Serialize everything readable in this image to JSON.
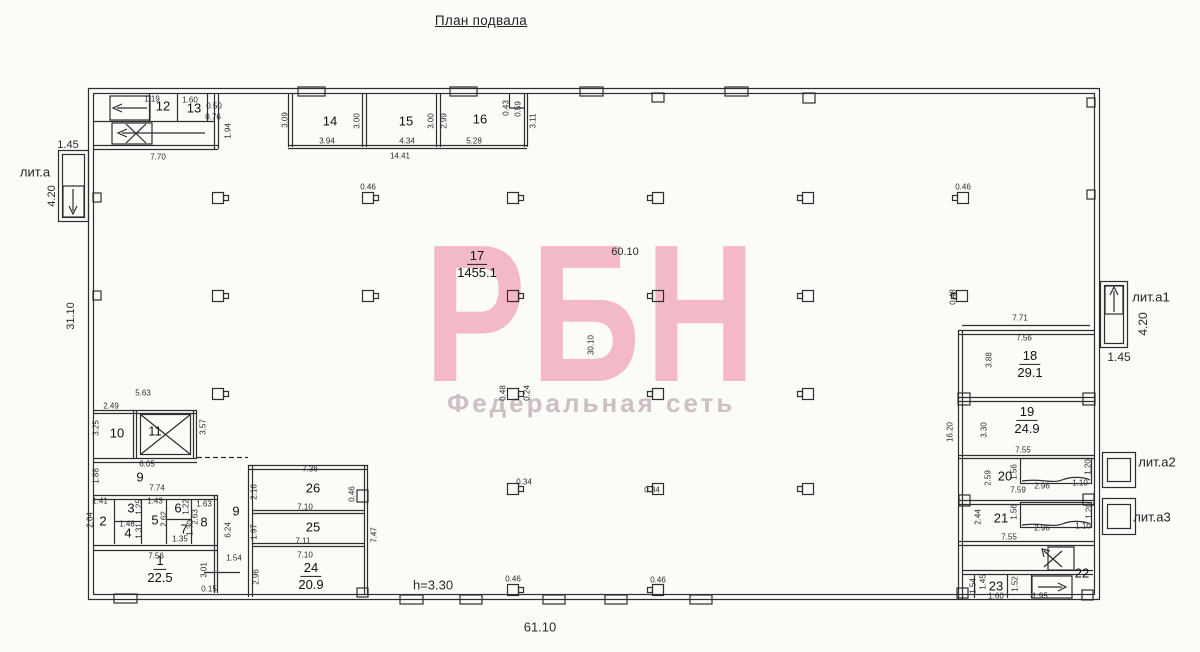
{
  "title": "План подвала",
  "watermark": {
    "brand": "РБН",
    "subtitle": "Федеральная сеть",
    "brand_color": "#f4b9c6",
    "subtitle_color": "#cdbfc3"
  },
  "plan": {
    "literas": [
      {
        "t": "лит.а",
        "x": 35,
        "y": 172
      },
      {
        "t": "лит.а1",
        "x": 1151,
        "y": 297
      },
      {
        "t": "лит.а2",
        "x": 1157,
        "y": 462
      },
      {
        "t": "лит.а3",
        "x": 1152,
        "y": 517
      }
    ],
    "rooms_with_area": [
      {
        "num": "17",
        "area": "1455.1",
        "x": 477,
        "y": 265
      },
      {
        "num": "18",
        "area": "29.1",
        "x": 1030,
        "y": 365
      },
      {
        "num": "19",
        "area": "24.9",
        "x": 1027,
        "y": 421
      },
      {
        "num": "24",
        "area": "20.9",
        "x": 311,
        "y": 577
      },
      {
        "num": "1",
        "area": "22.5",
        "x": 160,
        "y": 570
      }
    ],
    "room_numbers": [
      {
        "t": "12",
        "x": 163,
        "y": 106
      },
      {
        "t": "13",
        "x": 194,
        "y": 108
      },
      {
        "t": "14",
        "x": 330,
        "y": 121
      },
      {
        "t": "15",
        "x": 406,
        "y": 121
      },
      {
        "t": "16",
        "x": 480,
        "y": 119
      },
      {
        "t": "20",
        "x": 1005,
        "y": 476
      },
      {
        "t": "21",
        "x": 1001,
        "y": 518
      },
      {
        "t": "22",
        "x": 1082,
        "y": 573
      },
      {
        "t": "23",
        "x": 996,
        "y": 586
      },
      {
        "t": "25",
        "x": 313,
        "y": 527
      },
      {
        "t": "26",
        "x": 313,
        "y": 488
      },
      {
        "t": "2",
        "x": 103,
        "y": 521
      },
      {
        "t": "3",
        "x": 131,
        "y": 508
      },
      {
        "t": "4",
        "x": 128,
        "y": 533
      },
      {
        "t": "5",
        "x": 155,
        "y": 520
      },
      {
        "t": "6",
        "x": 178,
        "y": 508
      },
      {
        "t": "7",
        "x": 184,
        "y": 529
      },
      {
        "t": "8",
        "x": 204,
        "y": 522
      },
      {
        "t": "9",
        "x": 140,
        "y": 477
      },
      {
        "t": "9",
        "x": 236,
        "y": 511
      },
      {
        "t": "10",
        "x": 117,
        "y": 433
      },
      {
        "t": "11",
        "x": 155,
        "y": 431
      }
    ],
    "dims": [
      {
        "t": "1.45",
        "x": 68,
        "y": 145,
        "s": 11
      },
      {
        "t": "4.20",
        "x": 52,
        "y": 196,
        "s": 11,
        "r": 1
      },
      {
        "t": "31.10",
        "x": 71,
        "y": 316,
        "s": 11,
        "r": 1
      },
      {
        "t": "1.19",
        "x": 152,
        "y": 99
      },
      {
        "t": "1.60",
        "x": 190,
        "y": 100
      },
      {
        "t": "0.50",
        "x": 214,
        "y": 106
      },
      {
        "t": "0.76",
        "x": 213,
        "y": 117
      },
      {
        "t": "1.94",
        "x": 228,
        "y": 131,
        "r": 1
      },
      {
        "t": "7.70",
        "x": 158,
        "y": 157
      },
      {
        "t": "3.09",
        "x": 285,
        "y": 120,
        "r": 1
      },
      {
        "t": "3.94",
        "x": 327,
        "y": 141
      },
      {
        "t": "3.00",
        "x": 357,
        "y": 121,
        "r": 1
      },
      {
        "t": "4.34",
        "x": 407,
        "y": 141
      },
      {
        "t": "3.00",
        "x": 431,
        "y": 121,
        "r": 1
      },
      {
        "t": "14.41",
        "x": 400,
        "y": 156
      },
      {
        "t": "2.99",
        "x": 444,
        "y": 121,
        "r": 1
      },
      {
        "t": "5.28",
        "x": 474,
        "y": 141
      },
      {
        "t": "0.43",
        "x": 506,
        "y": 108,
        "r": 1
      },
      {
        "t": "0.59",
        "x": 518,
        "y": 109,
        "r": 1
      },
      {
        "t": "3.11",
        "x": 533,
        "y": 121,
        "r": 1
      },
      {
        "t": "0.46",
        "x": 368,
        "y": 187
      },
      {
        "t": "0.46",
        "x": 963,
        "y": 187
      },
      {
        "t": "0.48",
        "x": 953,
        "y": 297,
        "r": 1
      },
      {
        "t": "60.10",
        "x": 625,
        "y": 252,
        "s": 11
      },
      {
        "t": "30.10",
        "x": 591,
        "y": 345,
        "r": 1
      },
      {
        "t": "0.48",
        "x": 503,
        "y": 393,
        "r": 1
      },
      {
        "t": "0.24",
        "x": 527,
        "y": 393,
        "r": 1
      },
      {
        "t": "0.34",
        "x": 524,
        "y": 482
      },
      {
        "t": "0.34",
        "x": 652,
        "y": 490
      },
      {
        "t": "0.46",
        "x": 513,
        "y": 579
      },
      {
        "t": "0.46",
        "x": 658,
        "y": 580
      },
      {
        "t": "7.71",
        "x": 1020,
        "y": 318
      },
      {
        "t": "7.56",
        "x": 1024,
        "y": 338
      },
      {
        "t": "3.88",
        "x": 989,
        "y": 360,
        "r": 1
      },
      {
        "t": "16.20",
        "x": 950,
        "y": 432,
        "r": 1
      },
      {
        "t": "3.30",
        "x": 984,
        "y": 430,
        "r": 1
      },
      {
        "t": "7.55",
        "x": 1023,
        "y": 450
      },
      {
        "t": "2.59",
        "x": 988,
        "y": 478,
        "r": 1
      },
      {
        "t": "1.56",
        "x": 1014,
        "y": 472,
        "r": 1
      },
      {
        "t": "2.96",
        "x": 1042,
        "y": 486
      },
      {
        "t": "1.10",
        "x": 1080,
        "y": 483
      },
      {
        "t": "1.20",
        "x": 1088,
        "y": 467,
        "r": 1
      },
      {
        "t": "7.59",
        "x": 1018,
        "y": 490
      },
      {
        "t": "2.44",
        "x": 978,
        "y": 517,
        "r": 1
      },
      {
        "t": "1.56",
        "x": 1014,
        "y": 512,
        "r": 1
      },
      {
        "t": "2.96",
        "x": 1042,
        "y": 528
      },
      {
        "t": "1.10",
        "x": 1083,
        "y": 526
      },
      {
        "t": "1.20",
        "x": 1089,
        "y": 511,
        "r": 1
      },
      {
        "t": "7.55",
        "x": 1009,
        "y": 537
      },
      {
        "t": "1.54",
        "x": 973,
        "y": 586,
        "r": 1
      },
      {
        "t": "1.45",
        "x": 983,
        "y": 582,
        "r": 1
      },
      {
        "t": "1.52",
        "x": 1015,
        "y": 584,
        "r": 1
      },
      {
        "t": "1.60",
        "x": 996,
        "y": 596
      },
      {
        "t": "1.95",
        "x": 1040,
        "y": 596
      },
      {
        "t": "4.20",
        "x": 1143,
        "y": 324,
        "s": 12,
        "r": 1
      },
      {
        "t": "1.45",
        "x": 1119,
        "y": 357,
        "s": 12
      },
      {
        "t": "5.63",
        "x": 143,
        "y": 393
      },
      {
        "t": "2.49",
        "x": 111,
        "y": 406
      },
      {
        "t": "3.25",
        "x": 96,
        "y": 428,
        "r": 1
      },
      {
        "t": "3.57",
        "x": 203,
        "y": 427,
        "r": 1
      },
      {
        "t": "6.05",
        "x": 147,
        "y": 464
      },
      {
        "t": "1.88",
        "x": 96,
        "y": 476,
        "r": 1
      },
      {
        "t": "7.74",
        "x": 157,
        "y": 488
      },
      {
        "t": "1.41",
        "x": 100,
        "y": 501
      },
      {
        "t": "2.64",
        "x": 90,
        "y": 520,
        "r": 1
      },
      {
        "t": "1.25",
        "x": 139,
        "y": 507,
        "r": 1
      },
      {
        "t": "1.48",
        "x": 127,
        "y": 524
      },
      {
        "t": "1.31",
        "x": 139,
        "y": 531,
        "r": 1
      },
      {
        "t": "1.43",
        "x": 155,
        "y": 501
      },
      {
        "t": "2.62",
        "x": 164,
        "y": 519,
        "r": 1
      },
      {
        "t": "1.22",
        "x": 186,
        "y": 507,
        "r": 1
      },
      {
        "t": "1.30",
        "x": 190,
        "y": 528,
        "r": 1
      },
      {
        "t": "1.35",
        "x": 180,
        "y": 539
      },
      {
        "t": "1.63",
        "x": 204,
        "y": 504
      },
      {
        "t": "2.63",
        "x": 195,
        "y": 517,
        "r": 1
      },
      {
        "t": "6.24",
        "x": 228,
        "y": 530,
        "r": 1
      },
      {
        "t": "7.56",
        "x": 156,
        "y": 556
      },
      {
        "t": "3.01",
        "x": 204,
        "y": 570,
        "r": 1
      },
      {
        "t": "1.54",
        "x": 234,
        "y": 558
      },
      {
        "t": "0.15",
        "x": 209,
        "y": 589
      },
      {
        "t": "2.96",
        "x": 256,
        "y": 577,
        "r": 1
      },
      {
        "t": "7.36",
        "x": 310,
        "y": 469
      },
      {
        "t": "2.16",
        "x": 254,
        "y": 492,
        "r": 1
      },
      {
        "t": "7.10",
        "x": 305,
        "y": 507
      },
      {
        "t": "0.46",
        "x": 352,
        "y": 494,
        "r": 1
      },
      {
        "t": "1.97",
        "x": 254,
        "y": 532,
        "r": 1
      },
      {
        "t": "7.11",
        "x": 303,
        "y": 541
      },
      {
        "t": "7.10",
        "x": 305,
        "y": 555
      },
      {
        "t": "7.47",
        "x": 374,
        "y": 535,
        "r": 1
      },
      {
        "t": "h=3.30",
        "x": 433,
        "y": 585,
        "s": 13
      },
      {
        "t": "61.10",
        "x": 540,
        "y": 627,
        "s": 13
      }
    ]
  }
}
